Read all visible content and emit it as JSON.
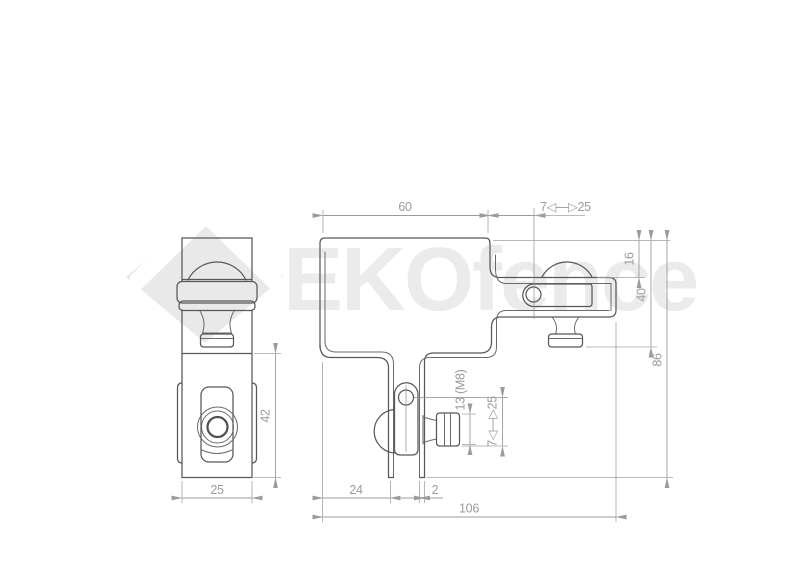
{
  "watermark": {
    "brand": "EKOfence"
  },
  "views": {
    "side_view": "side profile of bracket",
    "front_view": "front profile of bracket"
  },
  "dimensions": {
    "front_top_width": "60",
    "front_top_range": "7◁—▷25",
    "right_upper": "16",
    "right_mid": "40",
    "right_total": "86",
    "bottom_left": "24",
    "leg_thickness": "2",
    "bottom_total": "106",
    "hook_bolt": "13 (M8)",
    "hook_range": "7◁—▷25",
    "side_height": "42",
    "side_width": "25"
  }
}
